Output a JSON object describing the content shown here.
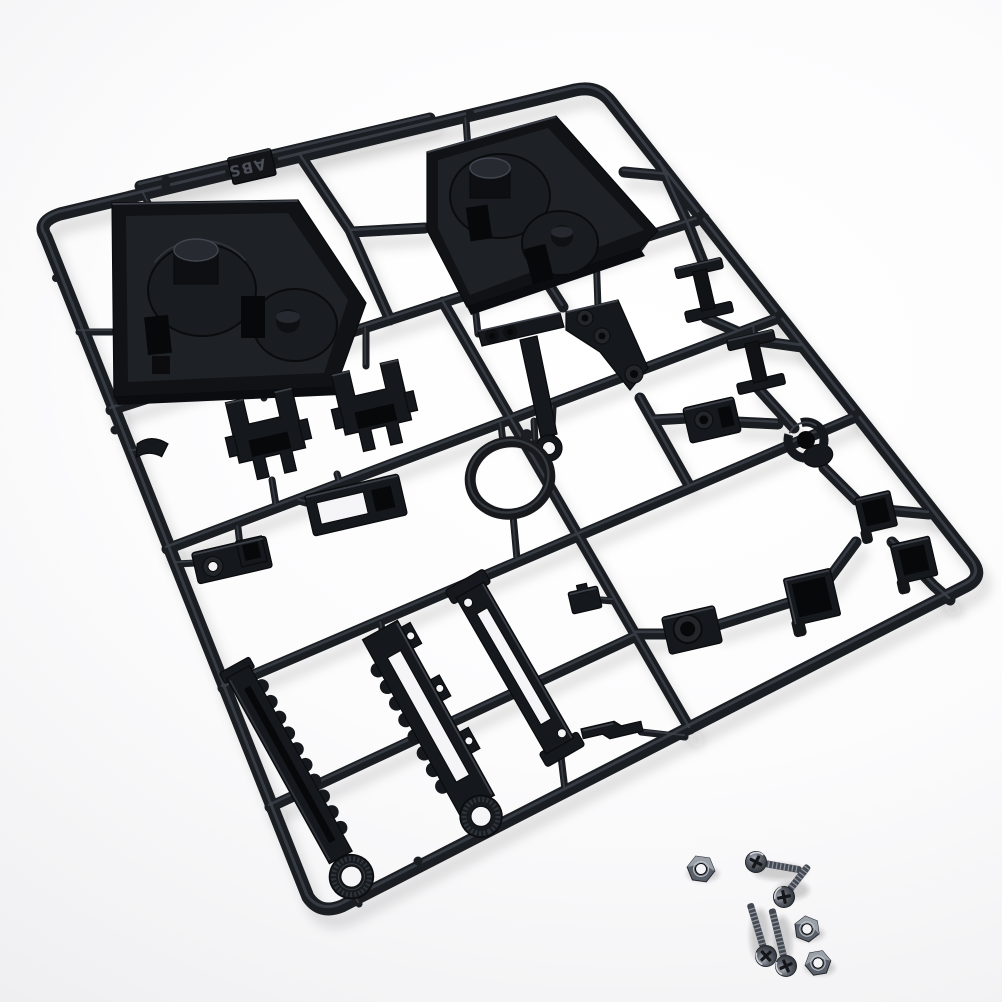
{
  "meta": {
    "type": "product-photo",
    "subject": "Black plastic model-kit parts sprue (injection-molded runner tree) with loose machine screws and hex nuts",
    "background_style": "seamless studio white",
    "orientation": "sprue rotated roughly 15 degrees, photographed from above"
  },
  "sprue": {
    "material_tag": "ABS",
    "tag_orientation": "upside-down",
    "plastic_color": "black",
    "base_hex": "#15181c",
    "outline_hex": "#0a0b0d",
    "highlight_hex": "#3c4149",
    "recess_hex": "#07080a",
    "frame_shape": "rounded rectangle runner frame with inner grid runners",
    "parts": [
      {
        "name": "triangular gearbox tray",
        "count": 2
      },
      {
        "name": "U-shaped mount bracket",
        "count": 2
      },
      {
        "name": "slotted tray lid",
        "count": 1
      },
      {
        "name": "suspension arm with eyelet",
        "count": 1
      },
      {
        "name": "stepped bracket with bosses",
        "count": 1
      },
      {
        "name": "I-beam spacer",
        "count": 2
      },
      {
        "name": "round pipe clamp",
        "count": 1
      },
      {
        "name": "square socket cup",
        "count": 4
      },
      {
        "name": "drilled mounting plate",
        "count": 3
      },
      {
        "name": "toothed rack arm with knurled hub",
        "count": 2
      },
      {
        "name": "slotted link bar",
        "count": 1
      },
      {
        "name": "circular ring",
        "count": 1
      },
      {
        "name": "small clip block",
        "count": 3
      },
      {
        "name": "corner elbow",
        "count": 1
      }
    ]
  },
  "hardware": {
    "screws": {
      "count": 4,
      "type": "phillips pan-head machine screw",
      "finish_hex": "#4c515a"
    },
    "nuts": {
      "count": 3,
      "type": "hex nut",
      "finish_hex": "#5a6069",
      "hole_shows_background": true
    }
  },
  "background": {
    "top_left_hex": "#e9e9eb",
    "center_hex": "#ffffff"
  }
}
